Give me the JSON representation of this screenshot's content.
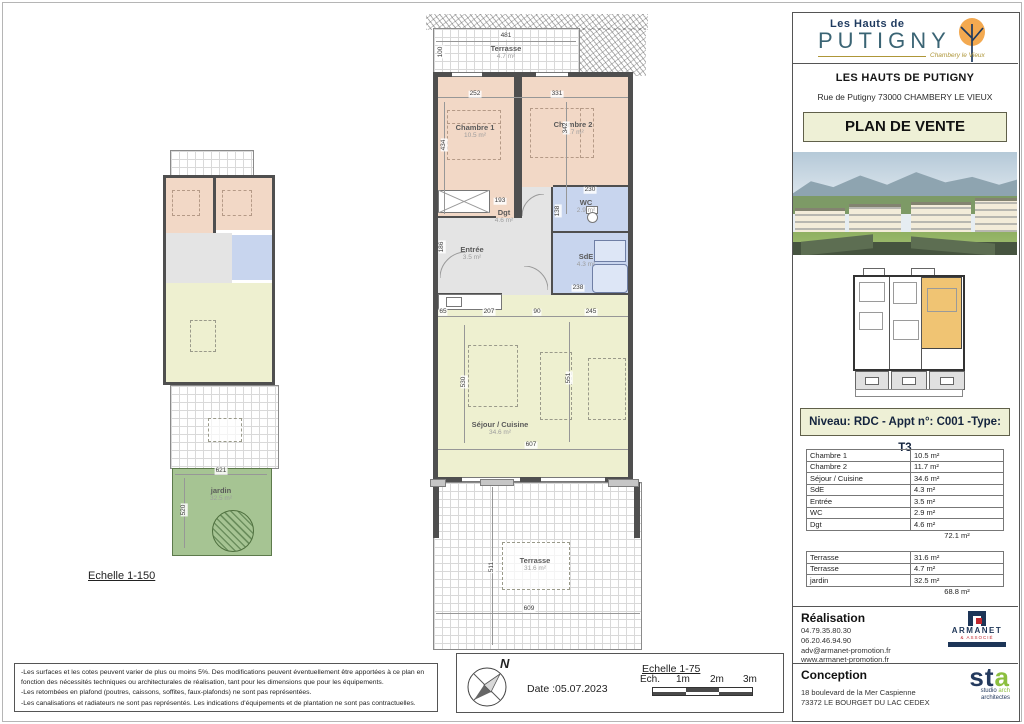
{
  "branding": {
    "logo_small": "Les Hauts de",
    "logo_main": "PUTIGNY",
    "logo_place": "Chambery le Vieux",
    "title": "LES HAUTS DE PUTIGNY",
    "address": "Rue de Putigny 73000 CHAMBERY LE VIEUX",
    "doc_type": "PLAN DE VENTE"
  },
  "unit_header": "Niveau: RDC - Appt n°: C001 -Type: T3",
  "areas": {
    "rooms": [
      {
        "label": "Chambre 1",
        "value": "10.5 m²"
      },
      {
        "label": "Chambre 2",
        "value": "11.7 m²"
      },
      {
        "label": "Séjour / Cuisine",
        "value": "34.6 m²"
      },
      {
        "label": "SdE",
        "value": "4.3 m²"
      },
      {
        "label": "Entrée",
        "value": "3.5 m²"
      },
      {
        "label": "WC",
        "value": "2.9 m²"
      },
      {
        "label": "Dgt",
        "value": "4.6 m²"
      }
    ],
    "rooms_total": "72.1 m²",
    "outdoor": [
      {
        "label": "Terrasse",
        "value": "31.6 m²"
      },
      {
        "label": "Terrasse",
        "value": "4.7 m²"
      },
      {
        "label": "jardin",
        "value": "32.5 m²"
      }
    ],
    "outdoor_total": "68.8 m²"
  },
  "realisation": {
    "heading": "Réalisation",
    "lines": [
      "04.79.35.80.30",
      "06.20.46.94.90",
      "adv@armanet-promotion.fr",
      "www.armanet-promotion.fr"
    ],
    "logo": {
      "name": "ARMANET",
      "sub": "& ASSOCIÉ"
    }
  },
  "conception": {
    "heading": "Conception",
    "lines": [
      "18 boulevard de la Mer Caspienne",
      "73372 LE BOURGET DU LAC CEDEX"
    ],
    "logo": {
      "main": "st",
      "accent": "a",
      "line1a": "studio ",
      "line1b": "arch",
      "line2": "architectes"
    }
  },
  "footer": {
    "disclaimers": [
      "-Les surfaces et les cotes peuvent varier de plus ou moins 5%. Des modifications peuvent éventuellement être apportées à ce plan en fonction des nécessités techniques ou architecturales de réalisation, tant pour les dimensions que pour les équipements.",
      "-Les retombées en plafond (poutres, caissons, soffites, faux-plafonds) ne sont pas représentées.",
      "-Les canalisations et radiateurs ne sont pas représentés. Les indications d'équipements et de plantation ne sont pas contractuelles."
    ],
    "north": "N",
    "date": "Date :05.07.2023",
    "scale_large_label": "Echelle 1-75",
    "scale_small_label": "Echelle 1-150",
    "scalebar": {
      "ech": "Ech.",
      "m1": "1m",
      "m2": "2m",
      "m3": "3m"
    }
  },
  "plan_large": {
    "terrasse_top": {
      "name": "Terrasse",
      "area": "4.7 m²"
    },
    "chambre1": {
      "name": "Chambre 1",
      "area": "10.5 m²"
    },
    "chambre2": {
      "name": "Chambre 2",
      "area": "11.7 m²"
    },
    "wc": {
      "name": "WC",
      "area": "2.9 m²"
    },
    "sde": {
      "name": "SdE",
      "area": "4.3 m²"
    },
    "dgt": {
      "name": "Dgt",
      "area": "4.6 m²"
    },
    "entree": {
      "name": "Entrée",
      "area": "3.5 m²"
    },
    "sejour": {
      "name": "Séjour / Cuisine",
      "area": "34.6 m²"
    },
    "terrasse_bottom": {
      "name": "Terrasse",
      "area": "31.6 m²"
    },
    "dims": {
      "d481": "481",
      "d100": "100",
      "d252": "252",
      "d331": "331",
      "d434": "434",
      "d342": "342",
      "d193": "193",
      "d230": "230",
      "d138": "138",
      "d186": "186",
      "d238": "238",
      "d65": "65",
      "d207": "207",
      "d90": "90",
      "d245": "245",
      "d530": "530",
      "d551": "551",
      "d607": "607",
      "d609": "609",
      "d511": "511"
    }
  },
  "plan_small": {
    "jardin": {
      "name": "jardin",
      "area": "32.5 m²"
    },
    "dims": {
      "d621": "621",
      "d520": "520"
    }
  },
  "colors": {
    "accent_khaki": "#eef0d6",
    "room_pink": "#f2d8c6",
    "room_blue": "#c8d5ee",
    "room_gray": "#e4e4e4",
    "room_yellow": "#eef0d0",
    "garden_green": "#a6c493",
    "highlight_orange": "#f0c473",
    "brand_navy": "#1e3a5f",
    "brand_teal": "#3a6474",
    "brand_gold": "#ae9638"
  }
}
